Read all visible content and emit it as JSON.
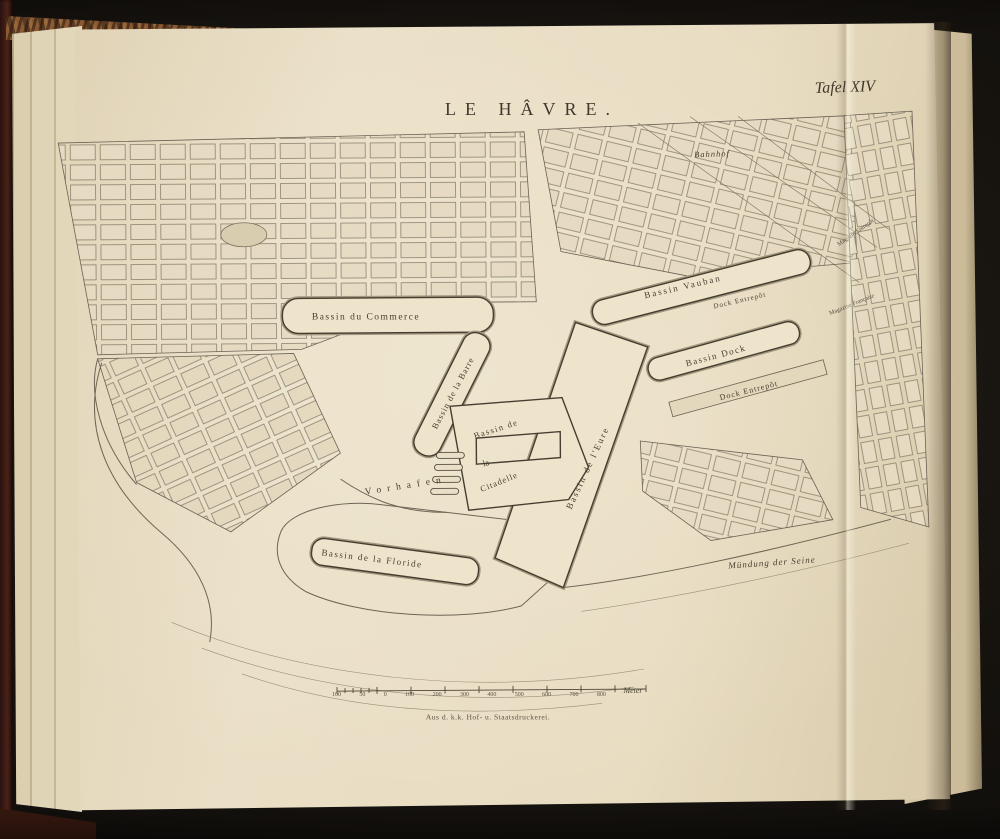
{
  "plate": {
    "number": "Tafel XIV",
    "title": "LE HÂVRE.",
    "imprint": "Aus d. k.k. Hof- u. Staatsdruckerei."
  },
  "labels": {
    "bahnhof": "Bahnhof",
    "bassin_du_commerce": "Bassin du Commerce",
    "bassin_vauban": "Bassin Vauban",
    "dock_entrepot_upper": "Dock Entrepôt",
    "bassin_dock": "Bassin Dock",
    "dock_entrepot_lower": "Dock Entrepôt",
    "bassin_de_la_barre": "Bassin de la Barre",
    "citadelle_line1": "Bassin de",
    "citadelle_line2": "la",
    "citadelle_line3": "Citadelle",
    "bassin_de_l_eure": "Bassin de l'Eure",
    "vorhafen": "Vorhafen",
    "bassin_de_la_floride": "Bassin de la Floride",
    "muendung_der_seine": "Mündung der Seine",
    "magazin_right_upper": "Magazin Entrepôt",
    "magazin_right_lower": "Magazine Française"
  },
  "scale": {
    "ticks": [
      "100",
      "50",
      "0",
      "100",
      "200",
      "300",
      "400",
      "500",
      "600",
      "700",
      "800"
    ],
    "unit": "Meter"
  }
}
